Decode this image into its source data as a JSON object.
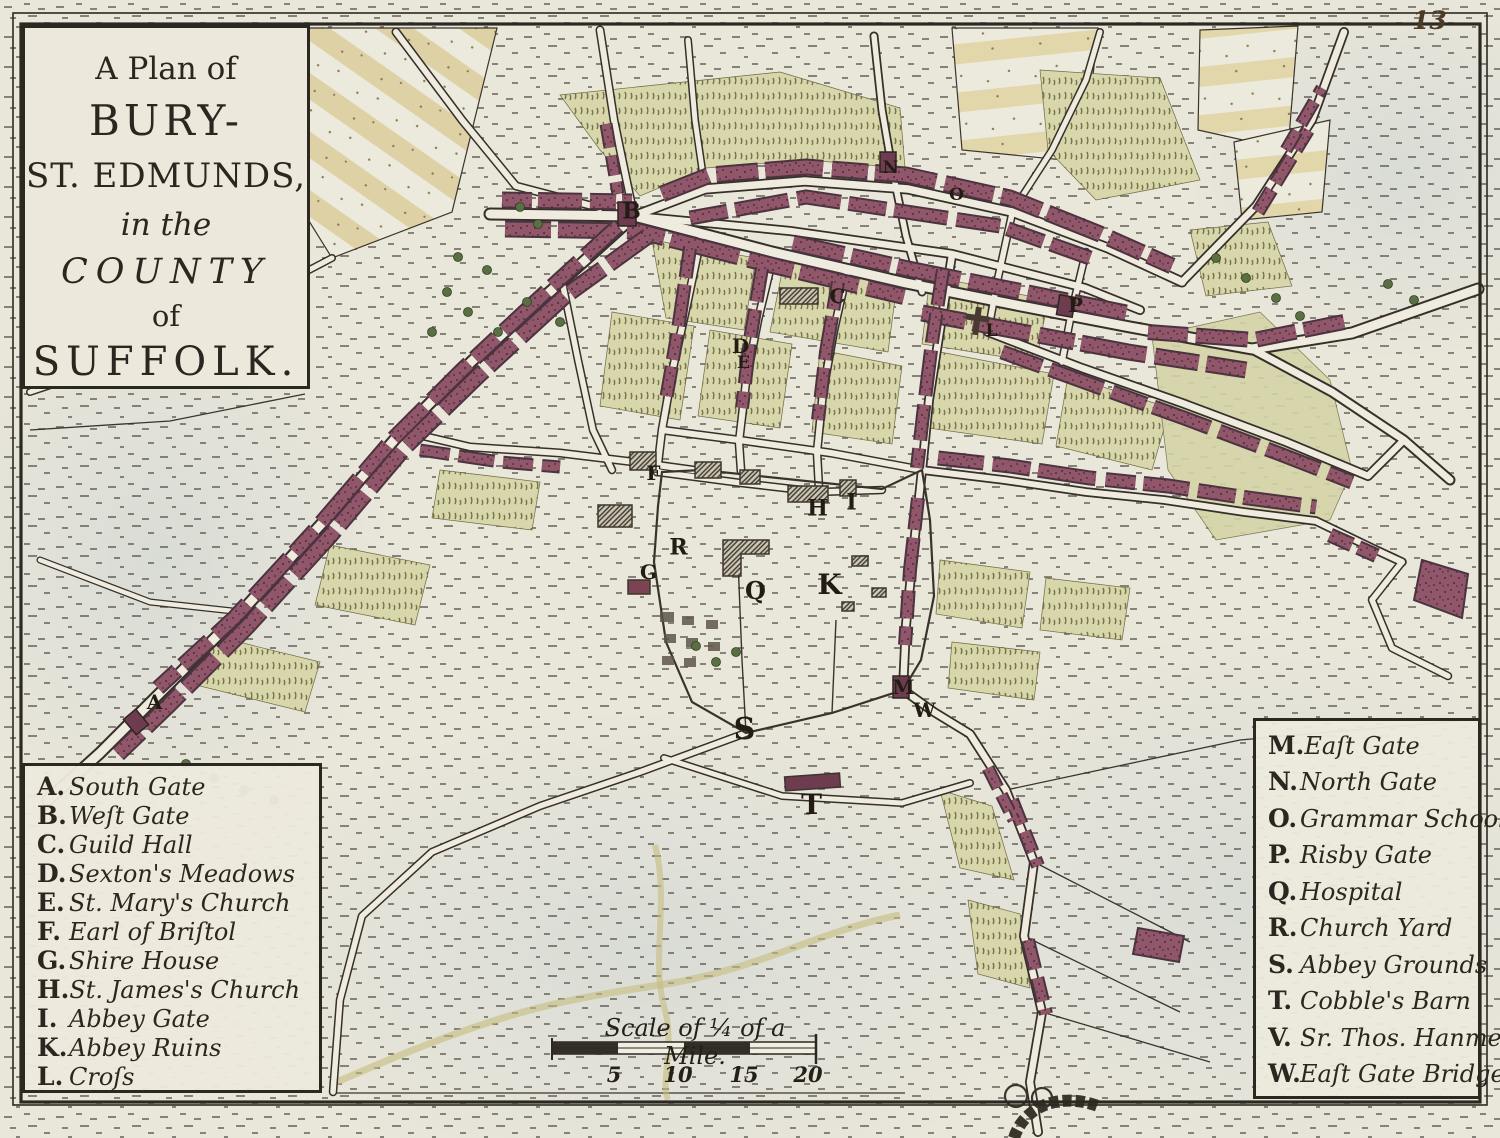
{
  "page": {
    "number": "13"
  },
  "title": {
    "line1": "A Plan of",
    "line2": "BURY-",
    "line3": "ST. EDMUNDS,",
    "line4": "in the",
    "line5": "COUNTY",
    "line6": "of",
    "line7": "SUFFOLK."
  },
  "legend_left": {
    "items": [
      {
        "key": "A.",
        "label": "South Gate"
      },
      {
        "key": "B.",
        "label": "Weſt Gate"
      },
      {
        "key": "C.",
        "label": "Guild Hall"
      },
      {
        "key": "D.",
        "label": "Sexton's Meadows"
      },
      {
        "key": "E.",
        "label": "St. Mary's Church"
      },
      {
        "key": "F.",
        "label": "Earl of Briſtol"
      },
      {
        "key": "G.",
        "label": "Shire House"
      },
      {
        "key": "H.",
        "label": "St. James's Church"
      },
      {
        "key": "I.",
        "label": "Abbey Gate"
      },
      {
        "key": "K.",
        "label": "Abbey Ruins"
      },
      {
        "key": "L.",
        "label": "Croſs"
      }
    ]
  },
  "legend_right": {
    "items": [
      {
        "key": "M.",
        "label": "Eaſt Gate"
      },
      {
        "key": "N.",
        "label": "North Gate"
      },
      {
        "key": "O.",
        "label": "Grammar School"
      },
      {
        "key": "P.",
        "label": "Risby Gate"
      },
      {
        "key": "Q.",
        "label": "Hospital"
      },
      {
        "key": "R.",
        "label": "Church Yard"
      },
      {
        "key": "S.",
        "label": "Abbey Grounds"
      },
      {
        "key": "T.",
        "label": "Cobble's Barn"
      },
      {
        "key": "V.",
        "label": "Sr. Thos. Hanmer"
      },
      {
        "key": "W.",
        "label": "Eaſt Gate Bridge"
      }
    ]
  },
  "scale": {
    "caption": "Scale of ¼ of a Mile.",
    "ticks": [
      {
        "label": "5",
        "x": 614,
        "y": 1062
      },
      {
        "label": "10",
        "x": 678,
        "y": 1062
      },
      {
        "label": "15",
        "x": 744,
        "y": 1062
      },
      {
        "label": "20",
        "x": 808,
        "y": 1062
      }
    ]
  },
  "map_letters": [
    {
      "char": "A",
      "x": 155,
      "y": 703,
      "size": 20
    },
    {
      "char": "B",
      "x": 632,
      "y": 213,
      "size": 22
    },
    {
      "char": "C",
      "x": 838,
      "y": 297,
      "size": 20
    },
    {
      "char": "D",
      "x": 741,
      "y": 347,
      "size": 20
    },
    {
      "char": "E",
      "x": 744,
      "y": 364,
      "size": 17
    },
    {
      "char": "F",
      "x": 654,
      "y": 474,
      "size": 20
    },
    {
      "char": "G",
      "x": 649,
      "y": 573,
      "size": 20
    },
    {
      "char": "H",
      "x": 818,
      "y": 510,
      "size": 22
    },
    {
      "char": "I",
      "x": 852,
      "y": 504,
      "size": 22
    },
    {
      "char": "K",
      "x": 830,
      "y": 586,
      "size": 28
    },
    {
      "char": "L",
      "x": 992,
      "y": 332,
      "size": 17
    },
    {
      "char": "M",
      "x": 904,
      "y": 688,
      "size": 20
    },
    {
      "char": "N",
      "x": 891,
      "y": 169,
      "size": 17
    },
    {
      "char": "O",
      "x": 957,
      "y": 196,
      "size": 17
    },
    {
      "char": "P",
      "x": 1076,
      "y": 306,
      "size": 20
    },
    {
      "char": "Q",
      "x": 756,
      "y": 592,
      "size": 24
    },
    {
      "char": "R",
      "x": 679,
      "y": 549,
      "size": 22
    },
    {
      "char": "S",
      "x": 745,
      "y": 731,
      "size": 30
    },
    {
      "char": "T",
      "x": 812,
      "y": 806,
      "size": 28
    },
    {
      "char": "W",
      "x": 925,
      "y": 711,
      "size": 20
    }
  ],
  "colors": {
    "paper": "#e9e6da",
    "ink": "#2e2a23",
    "building": "#90576a",
    "garden": "#d8d6ab",
    "stripe_field": "#decfa0",
    "tree": "#5a7040"
  }
}
